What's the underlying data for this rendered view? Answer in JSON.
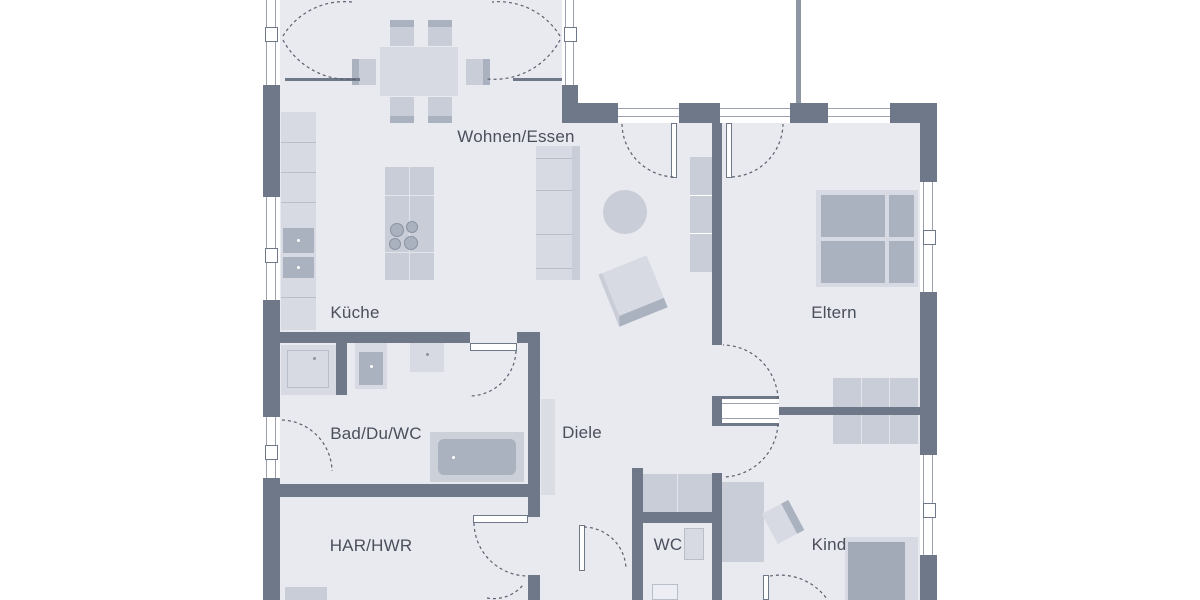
{
  "plan": {
    "rooms": [
      {
        "name": "wohnen-essen",
        "label": "Wohnen/Essen"
      },
      {
        "name": "kueche",
        "label": "Küche"
      },
      {
        "name": "eltern",
        "label": "Eltern"
      },
      {
        "name": "bad-du-wc",
        "label": "Bad/Du/WC"
      },
      {
        "name": "diele",
        "label": "Diele"
      },
      {
        "name": "har-hwr",
        "label": "HAR/HWR"
      },
      {
        "name": "wc",
        "label": "WC"
      },
      {
        "name": "kind",
        "label": "Kind"
      }
    ],
    "colors": {
      "background": "#ffffff",
      "floor": "#e8eaf0",
      "wall": "#6e7889",
      "wall_light": "#8e96a4",
      "furniture_light": "#d7dae2",
      "furniture_mid": "#c9cdd7",
      "furniture_dark": "#aab1bf",
      "line": "#b9bfca",
      "arc": "#5a606e",
      "label_text": "#4a4f5b"
    }
  }
}
